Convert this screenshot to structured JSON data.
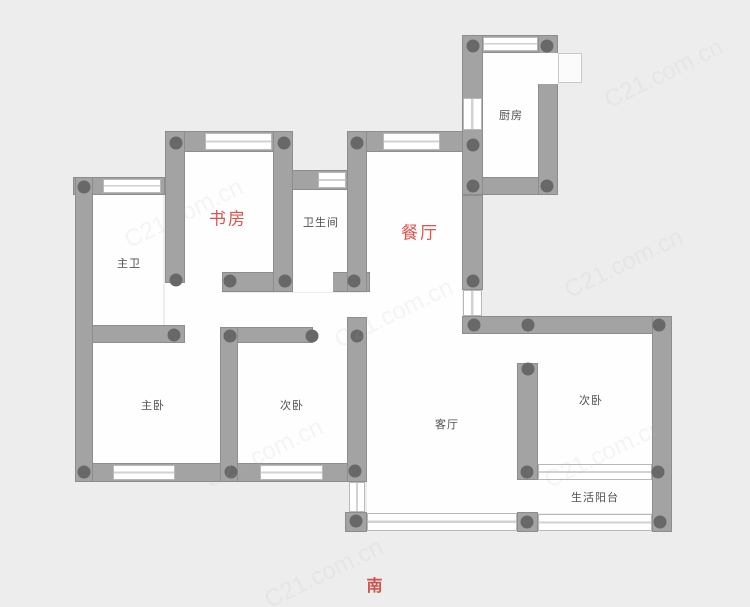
{
  "plan": {
    "compass": {
      "label": "南",
      "x": 375,
      "y": 584
    },
    "watermark_text": "C21.com.cn",
    "colors": {
      "background": "#ededed",
      "room_fill": "#fefefe",
      "wall_fill": "#a3a3a3",
      "wall_edge": "#8d8d8d",
      "column_dot": "#686868",
      "label_text": "#4f4f4f",
      "accent_red": "#db544e"
    },
    "rooms": [
      {
        "id": "study",
        "label": "书房",
        "emphasis": true,
        "cx": 228,
        "cy": 217
      },
      {
        "id": "toilet",
        "label": "卫生间",
        "emphasis": false,
        "cx": 321,
        "cy": 222
      },
      {
        "id": "dining",
        "label": "餐厅",
        "emphasis": true,
        "cx": 420,
        "cy": 231
      },
      {
        "id": "kitchen",
        "label": "厨房",
        "emphasis": false,
        "cx": 511,
        "cy": 115
      },
      {
        "id": "master-bath",
        "label": "主卫",
        "emphasis": false,
        "cx": 129,
        "cy": 263
      },
      {
        "id": "master-bedroom",
        "label": "主卧",
        "emphasis": false,
        "cx": 153,
        "cy": 405
      },
      {
        "id": "bedroom-second",
        "label": "次卧",
        "emphasis": false,
        "cx": 292,
        "cy": 405
      },
      {
        "id": "living",
        "label": "客厅",
        "emphasis": false,
        "cx": 447,
        "cy": 424
      },
      {
        "id": "bedroom-third",
        "label": "次卧",
        "emphasis": false,
        "cx": 591,
        "cy": 400
      },
      {
        "id": "service-balcony",
        "label": "生活阳台",
        "emphasis": false,
        "cx": 595,
        "cy": 497
      }
    ],
    "geometry": {
      "interiors": [
        [
          93,
          195,
          70,
          130
        ],
        [
          185,
          152,
          88,
          121
        ],
        [
          293,
          190,
          55,
          83
        ],
        [
          483,
          53,
          55,
          124
        ],
        [
          367,
          152,
          95,
          361
        ],
        [
          462,
          334,
          55,
          179
        ],
        [
          185,
          293,
          182,
          34
        ],
        [
          93,
          343,
          127,
          121
        ],
        [
          238,
          343,
          109,
          121
        ],
        [
          538,
          334,
          114,
          130
        ],
        [
          538,
          480,
          114,
          33
        ]
      ],
      "walls": [
        [
          165,
          131,
          128,
          21
        ],
        [
          347,
          131,
          118,
          21
        ],
        [
          73,
          177,
          92,
          18
        ],
        [
          288,
          170,
          60,
          20
        ],
        [
          222,
          272,
          148,
          20
        ],
        [
          75,
          325,
          110,
          18
        ],
        [
          222,
          327,
          91,
          16
        ],
        [
          75,
          463,
          292,
          19
        ],
        [
          462,
          35,
          96,
          18
        ],
        [
          462,
          177,
          96,
          18
        ],
        [
          462,
          316,
          210,
          18
        ],
        [
          345,
          512,
          22,
          20
        ],
        [
          517,
          512,
          21,
          20
        ],
        [
          652,
          512,
          20,
          20
        ],
        [
          75,
          177,
          18,
          305
        ],
        [
          165,
          131,
          20,
          152
        ],
        [
          273,
          131,
          20,
          161
        ],
        [
          347,
          131,
          20,
          161
        ],
        [
          347,
          317,
          20,
          165
        ],
        [
          220,
          327,
          18,
          155
        ],
        [
          462,
          35,
          21,
          160
        ],
        [
          538,
          35,
          20,
          160
        ],
        [
          462,
          195,
          21,
          95
        ],
        [
          652,
          316,
          20,
          216
        ],
        [
          517,
          363,
          21,
          117
        ]
      ],
      "openings": [
        [
          293,
          272,
          40,
          20
        ],
        [
          538,
          53,
          20,
          31
        ],
        [
          165,
          283,
          20,
          42
        ],
        [
          185,
          325,
          35,
          18
        ],
        [
          313,
          327,
          34,
          16
        ],
        [
          517,
          334,
          21,
          29
        ],
        [
          517,
          480,
          21,
          32
        ],
        [
          185,
          272,
          37,
          21
        ]
      ],
      "windows": [
        [
          205,
          133,
          67,
          17,
          "h"
        ],
        [
          383,
          133,
          57,
          17,
          "h"
        ],
        [
          103,
          179,
          58,
          14,
          "h"
        ],
        [
          318,
          172,
          28,
          16,
          "h"
        ],
        [
          483,
          37,
          55,
          14,
          "h"
        ],
        [
          463,
          98,
          19,
          32,
          "v"
        ],
        [
          463,
          290,
          19,
          26,
          "v"
        ],
        [
          113,
          465,
          62,
          15,
          "h"
        ],
        [
          260,
          465,
          63,
          15,
          "h"
        ],
        [
          349,
          482,
          16,
          30,
          "v"
        ],
        [
          367,
          513,
          150,
          18,
          "h"
        ],
        [
          538,
          464,
          114,
          16,
          "h"
        ],
        [
          538,
          514,
          114,
          17,
          "h"
        ]
      ],
      "door_leaf": [
        558,
        53,
        24,
        30
      ],
      "dots": [
        [
          176,
          143
        ],
        [
          284,
          143
        ],
        [
          357,
          143
        ],
        [
          473,
          46
        ],
        [
          547,
          46
        ],
        [
          84,
          187
        ],
        [
          473,
          145
        ],
        [
          473,
          186
        ],
        [
          547,
          186
        ],
        [
          176,
          280
        ],
        [
          230,
          281
        ],
        [
          285,
          281
        ],
        [
          354,
          281
        ],
        [
          473,
          281
        ],
        [
          174,
          335
        ],
        [
          230,
          336
        ],
        [
          312,
          336
        ],
        [
          357,
          336
        ],
        [
          474,
          325
        ],
        [
          528,
          325
        ],
        [
          659,
          325
        ],
        [
          528,
          369
        ],
        [
          84,
          472
        ],
        [
          231,
          472
        ],
        [
          355,
          471
        ],
        [
          527,
          472
        ],
        [
          658,
          472
        ],
        [
          356,
          521
        ],
        [
          527,
          522
        ],
        [
          660,
          522
        ]
      ],
      "watermarks": [
        [
          120,
          200
        ],
        [
          330,
          300
        ],
        [
          560,
          250
        ],
        [
          200,
          440
        ],
        [
          540,
          440
        ],
        [
          600,
          60
        ],
        [
          260,
          560
        ]
      ]
    }
  }
}
